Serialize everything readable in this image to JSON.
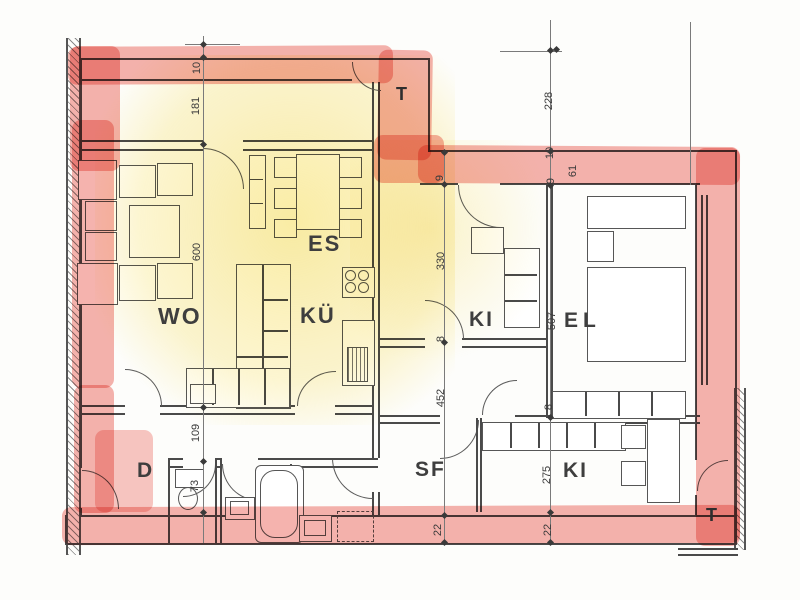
{
  "rooms": {
    "wo": "WO",
    "es": "ES",
    "kue": "KÜ",
    "ki_top": "KI",
    "el": "EL",
    "diele": "D",
    "sf": "SF",
    "ki_bottom": "KI",
    "terrace_top": "T",
    "terrace_bottom": "T"
  },
  "dims": {
    "left": {
      "a": "10",
      "b": "181",
      "c": "600",
      "d": "109",
      "e": "73"
    },
    "mid": {
      "a": "9",
      "b": "330",
      "c": "8",
      "d": "452",
      "e": "22"
    },
    "right": {
      "a": "228",
      "b": "10",
      "c": "9",
      "d": "61",
      "e": "507",
      "f": "8",
      "g": "275",
      "h": "22"
    }
  },
  "colors": {
    "wall_marker": "#ef8078",
    "room_marker": "#f6dd6e",
    "ink": "#4a4a4a"
  }
}
